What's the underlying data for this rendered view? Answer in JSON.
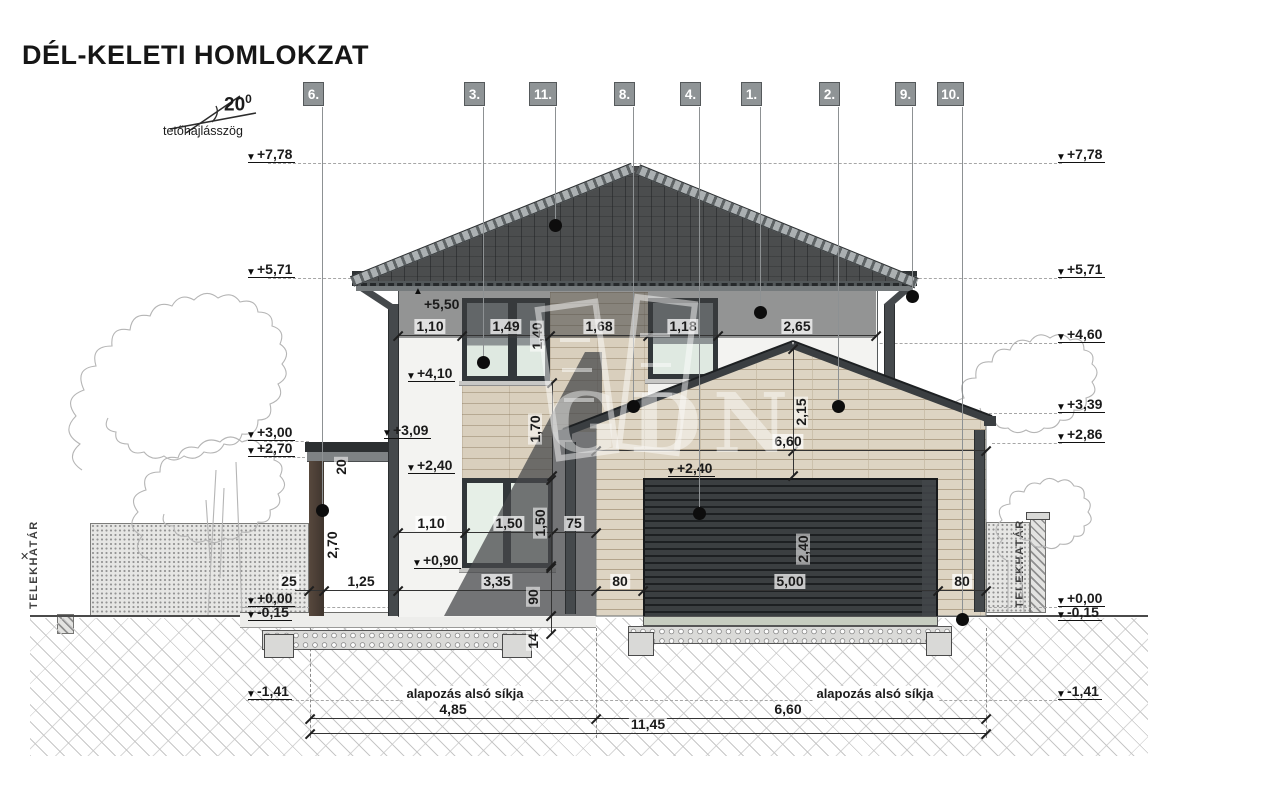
{
  "title": "DÉL-KELETI HOMLOKZAT",
  "roof_angle": {
    "value": "20",
    "exp": "0",
    "label": "tetőhajlásszög"
  },
  "boundary": {
    "label": "TELEKHATÁR"
  },
  "foundation": {
    "label": "alapozás alsó síkja"
  },
  "watermark": {
    "text": "GDN"
  },
  "markers": [
    {
      "label": "6.",
      "x": 303,
      "w": 21,
      "line_x": 322,
      "dot_y": 510
    },
    {
      "label": "3.",
      "x": 464,
      "w": 21,
      "line_x": 483,
      "dot_y": 362
    },
    {
      "label": "11.",
      "x": 529,
      "w": 28,
      "line_x": 555,
      "dot_y": 225
    },
    {
      "label": "8.",
      "x": 614,
      "w": 21,
      "line_x": 633,
      "dot_y": 406
    },
    {
      "label": "4.",
      "x": 680,
      "w": 21,
      "line_x": 699,
      "dot_y": 513
    },
    {
      "label": "1.",
      "x": 741,
      "w": 21,
      "line_x": 760,
      "dot_y": 312
    },
    {
      "label": "2.",
      "x": 819,
      "w": 21,
      "line_x": 838,
      "dot_y": 406
    },
    {
      "label": "9.",
      "x": 895,
      "w": 21,
      "line_x": 912,
      "dot_y": 296
    },
    {
      "label": "10.",
      "x": 937,
      "w": 27,
      "line_x": 962,
      "dot_y": 619
    }
  ],
  "levels_left": [
    {
      "label": "+7,78",
      "y": 163
    },
    {
      "label": "+5,71",
      "y": 278
    },
    {
      "label": "+3,00",
      "y": 441
    },
    {
      "label": "+2,70",
      "y": 457
    },
    {
      "label": "+0,00",
      "y": 607
    },
    {
      "label": "-0,15",
      "y": 621
    },
    {
      "label": "-1,41",
      "y": 700
    }
  ],
  "levels_right": [
    {
      "label": "+7,78",
      "y": 163
    },
    {
      "label": "+5,71",
      "y": 278
    },
    {
      "label": "+4,60",
      "y": 343
    },
    {
      "label": "+3,39",
      "y": 413
    },
    {
      "label": "+2,86",
      "y": 443
    },
    {
      "label": "+0,00",
      "y": 607
    },
    {
      "label": "-0,15",
      "y": 621
    },
    {
      "label": "-1,41",
      "y": 700
    }
  ],
  "levels_wall": [
    {
      "label": "+5,50",
      "x": 415,
      "y": 313,
      "dir": "up"
    },
    {
      "label": "+4,10",
      "x": 408,
      "y": 382,
      "dir": "down"
    },
    {
      "label": "+2,40",
      "x": 408,
      "y": 474,
      "dir": "down"
    },
    {
      "label": "+0,90",
      "x": 414,
      "y": 569,
      "dir": "down"
    },
    {
      "label": "+3,09",
      "x": 384,
      "y": 439,
      "dir": "down"
    },
    {
      "label": "+2,40",
      "x": 668,
      "y": 477,
      "dir": "down"
    }
  ],
  "dim_rows": [
    {
      "y": 335,
      "x1": 398,
      "x2": 876,
      "ticks": [
        398,
        462,
        550,
        648,
        718,
        876
      ],
      "segments": [
        {
          "cx": 430,
          "label": "1,10"
        },
        {
          "cx": 506,
          "label": "1,49"
        },
        {
          "cx": 599,
          "label": "1,68"
        },
        {
          "cx": 683,
          "label": "1,18"
        },
        {
          "cx": 797,
          "label": "2,65"
        }
      ]
    },
    {
      "y": 450,
      "x1": 596,
      "x2": 986,
      "ticks": [
        596,
        793,
        986
      ],
      "segments": [
        {
          "cx": 788,
          "label": "6,60"
        }
      ]
    },
    {
      "y": 532,
      "x1": 398,
      "x2": 596,
      "ticks": [
        398,
        465,
        553,
        596
      ],
      "segments": [
        {
          "cx": 431,
          "label": "1,10"
        },
        {
          "cx": 509,
          "label": "1,50"
        },
        {
          "cx": 574,
          "label": "75"
        }
      ]
    },
    {
      "y": 590,
      "x1": 295,
      "x2": 986,
      "ticks": [
        309,
        324,
        398,
        596,
        643,
        938,
        986
      ],
      "segments": [
        {
          "cx": 289,
          "label": "25"
        },
        {
          "cx": 361,
          "label": "1,25"
        },
        {
          "cx": 497,
          "label": "3,35"
        },
        {
          "cx": 620,
          "label": "80"
        },
        {
          "cx": 790,
          "label": "5,00"
        },
        {
          "cx": 962,
          "label": "80"
        }
      ]
    },
    {
      "y": 718,
      "x1": 310,
      "x2": 986,
      "ticks": [
        310,
        596,
        986
      ],
      "segments": [
        {
          "cx": 453,
          "label": "4,85"
        },
        {
          "cx": 788,
          "label": "6,60"
        }
      ]
    },
    {
      "y": 733,
      "x1": 310,
      "x2": 986,
      "ticks": [
        310,
        986
      ],
      "segments": [
        {
          "cx": 648,
          "label": "11,45"
        }
      ]
    }
  ],
  "dims_vertical": [
    {
      "label": "1,40",
      "x": 537,
      "y": 336
    },
    {
      "label": "1,70",
      "x": 535,
      "y": 429
    },
    {
      "label": "1,50",
      "x": 540,
      "y": 523
    },
    {
      "label": "90",
      "x": 533,
      "y": 597
    },
    {
      "label": "14",
      "x": 533,
      "y": 641
    },
    {
      "label": "2,70",
      "x": 332,
      "y": 545
    },
    {
      "label": "20",
      "x": 341,
      "y": 467
    },
    {
      "label": "2,15",
      "x": 801,
      "y": 412
    },
    {
      "label": "2,40",
      "x": 803,
      "y": 549
    }
  ]
}
